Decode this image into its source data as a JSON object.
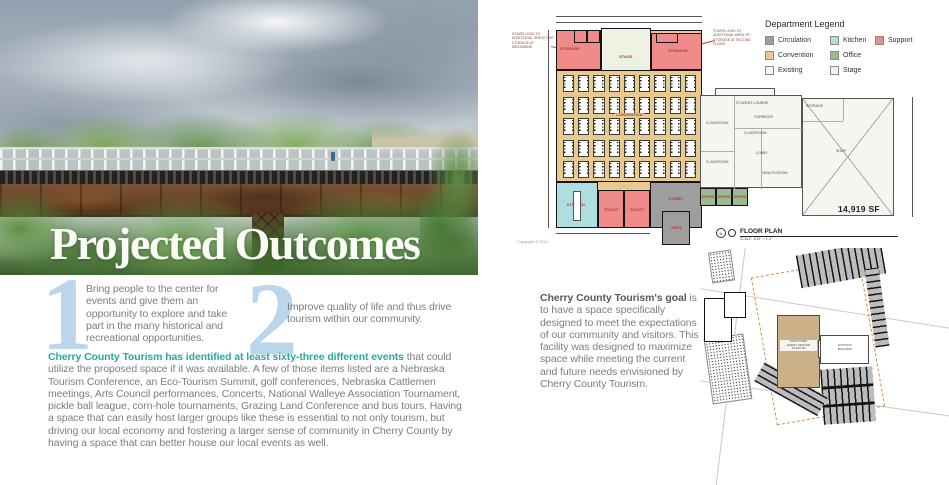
{
  "left": {
    "title": "Projected Outcomes",
    "points": [
      {
        "number": "1",
        "text": "Bring people to the center for events and give them an opportunity to explore and take part in the many historical and recreational opportunities."
      },
      {
        "number": "2",
        "text": "Improve quality of life and thus drive tourism within our community."
      }
    ],
    "para_lead": "Cherry County Tourism has identified at least sixty-three different events",
    "para_body": " that could utilize the proposed space if it was available. A few of those items listed are a Nebraska Tourism Conference, an Eco-Tourism Summit, golf conferences, Nebraska Cattlemen meetings, Arts Council performances, Concerts, National Walleye Association Tournament, pickle ball league, corn-hole tournaments, Grazing Land Conference and bus tours. Having a space that can easily host larger groups like these is essential to not only tourism, but driving our local economy and fostering a larger sense of community in Cherry County by having a space that can better house our local events as well."
  },
  "right": {
    "legend": {
      "title": "Department Legend",
      "items": [
        {
          "label": "Circulation",
          "color": "#9e9e9e",
          "col": 0,
          "row": 0
        },
        {
          "label": "Convention",
          "color": "#e8c98f",
          "col": 0,
          "row": 1
        },
        {
          "label": "Existing",
          "color": "#f6f6f1",
          "col": 0,
          "row": 2
        },
        {
          "label": "Kitchen",
          "color": "#aedee0",
          "col": 1,
          "row": 0
        },
        {
          "label": "Office",
          "color": "#9db893",
          "col": 1,
          "row": 1
        },
        {
          "label": "Stage",
          "color": "#eef2e2",
          "col": 1,
          "row": 2
        },
        {
          "label": "Support",
          "color": "#ef8b8b",
          "col": 2,
          "row": 0
        }
      ]
    },
    "fp": {
      "rooms": {
        "storage_left": "STORAGE",
        "stage": "STAGE",
        "storage_right": "STORAGE",
        "convention": "CONVENTION",
        "kitchen": "KITCHEN",
        "toilet_a": "TOILET",
        "toilet_b": "TOILET",
        "lobby": "LOBBY",
        "vestibule": "VEST.",
        "offices": [
          "OFFICE",
          "OFFICE",
          "OFFICE"
        ]
      },
      "ex_rooms": [
        "CLASSROOM",
        "CLASSROOM",
        "CLASSROOM",
        "STUDENT LOUNGE",
        "CORRIDOR",
        "LOBBY",
        "HEALTH ROOM",
        "STORAGE",
        "SHOP"
      ],
      "notes": {
        "left": "STAIRS LEAD TO ADDITIONAL SPACE FOR STORAGE AT MEZZANINE",
        "right": "STAIRS LEAD TO ADDITIONAL AREA OF STORAGE AT SECOND FLOOR"
      },
      "area": "14,919 SF",
      "caption": "FLOOR PLAN",
      "scale": "SCALE: 3/32\" = 1'-0\"",
      "copyright": "Copyright © 2021",
      "tables": {
        "rows": 5,
        "cols": 9
      }
    },
    "site": {
      "proposed_lines": [
        "PROPOSED",
        "EVENT CENTER",
        "14,919 SF"
      ],
      "existing_lines": [
        "EXISTING",
        "BUILDING"
      ]
    },
    "goal_lead": "Cherry County Tourism's goal",
    "goal_body": " is to have a space specifically designed to meet the expectations of our community and visitors. This facility was designed to maximize space while meeting the current and future needs envisioned by Cherry County Tourism."
  }
}
